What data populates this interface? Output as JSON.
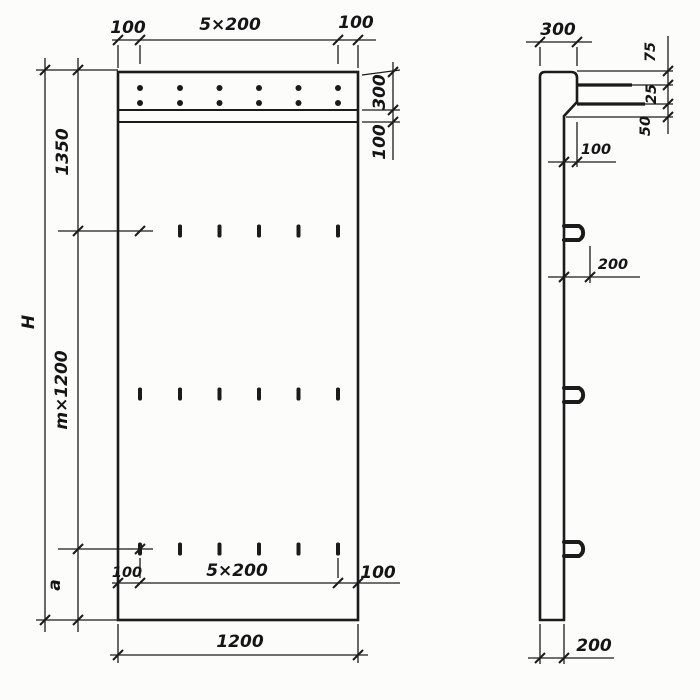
{
  "front_view": {
    "top_dims": {
      "left": "100",
      "center": "5×200",
      "right": "100"
    },
    "right_dims": {
      "band": "300",
      "strip": "100"
    },
    "left_dims": {
      "total": "H",
      "top": "1350",
      "middle": "m×1200",
      "bottom": "a"
    },
    "inner_bottom_dims": {
      "left": "100",
      "center": "5×200",
      "right": "100"
    },
    "bottom_dims": {
      "width": "1200"
    }
  },
  "side_view": {
    "top_dims": {
      "width": "300"
    },
    "ledge_dims": {
      "seg1": "75",
      "seg2": "25",
      "seg3": "50"
    },
    "taper_dim": "100",
    "loop_dim": "200",
    "bottom_dims": {
      "thickness": "200"
    }
  },
  "colors": {
    "ink": "#1b1b1b",
    "paper": "#fcfcfa"
  }
}
